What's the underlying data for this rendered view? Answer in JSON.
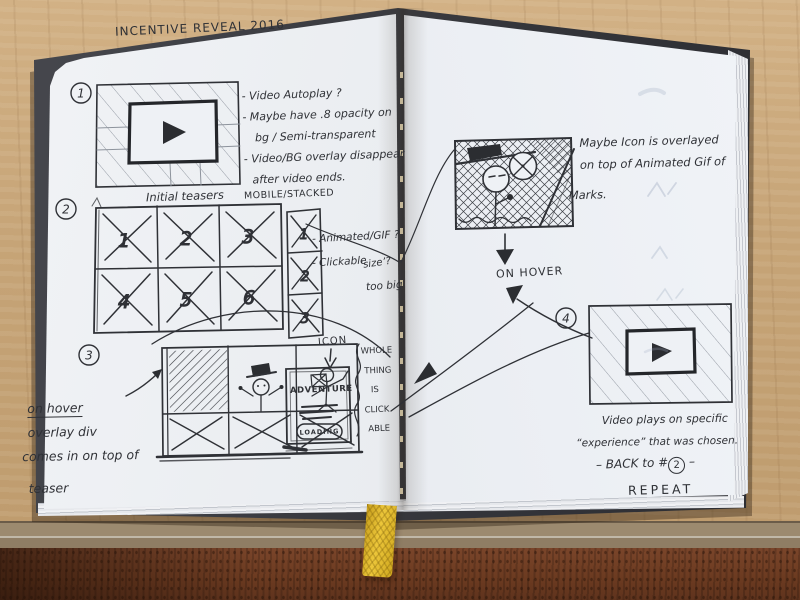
{
  "notebook": {
    "left_page": {
      "title": "INCENTIVE REVEAL 2016",
      "panel1": {
        "number": "1",
        "notes": [
          "- Video Autoplay ?",
          "- Maybe have .8 opacity on",
          "bg / Semi-transparent",
          "- Video/BG overlay disappear",
          "after video ends."
        ]
      },
      "panel2": {
        "number": "2",
        "grid_label": "Initial teasers",
        "mobile_label": "MOBILE/STACKED",
        "desktop_cell_numbers": [
          "1",
          "2",
          "3",
          "4",
          "5",
          "6"
        ],
        "mobile_cell_numbers": [
          "1",
          "2",
          "3"
        ],
        "note_animated": "- Animated/GIF ?",
        "note_clickable": "- Clickable",
        "note_size": "‘size’?",
        "note_too_big": "too big"
      },
      "panel3": {
        "number": "3",
        "notes": [
          "on hover",
          "overlay div",
          "comes in on top of",
          "teaser"
        ]
      },
      "icon_card": {
        "pointer_label": "ICON",
        "title": "ADVENTURE",
        "button_label": "LOADING",
        "side_note": [
          "WHOLE",
          "THING",
          "IS",
          "CLICK",
          "ABLE"
        ]
      }
    },
    "right_page": {
      "gif_sketch_note": [
        "Maybe Icon is overlayed",
        "on top of Animated Gif of",
        "Marks."
      ],
      "hover_label": "ON HOVER",
      "panel4": {
        "number": "4",
        "notes": [
          "Video plays on specific",
          "“experience” that was chosen."
        ],
        "back_prefix": "– BACK to #",
        "back_number": "2",
        "back_suffix": " –",
        "repeat_label": "REPEAT"
      }
    }
  },
  "icons": {
    "play_icon": "right-pointing-triangle",
    "x_placeholder_icon": "crossed-box"
  },
  "colors": {
    "ink": "#2f3136",
    "pencil": "#8d939c",
    "paper": "#e9edf2",
    "wood_light": "#c6a477",
    "wood_dark": "#6e3c21",
    "cover": "#3a3b41",
    "ribbon": "#e7bd27"
  }
}
